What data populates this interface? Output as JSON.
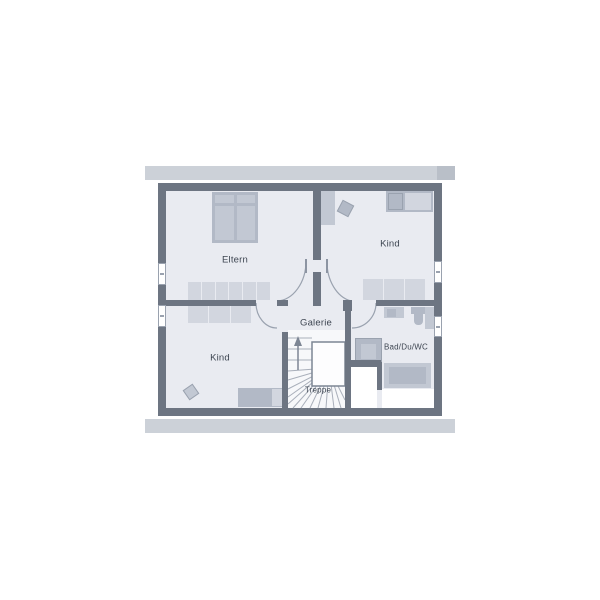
{
  "plan_title": "Obergeschoss Grundriss",
  "rooms": {
    "parents": "Eltern",
    "child_top": "Kind",
    "child_bottom": "Kind",
    "bath": "Bad/Du/WC",
    "gallery": "Galerie",
    "stairs": "Treppe"
  },
  "colors": {
    "wall": "#6d7582",
    "floor": "#e9ebf1",
    "band": "#ccd1d8",
    "band_cap": "#b9bfc8",
    "furn_light": "#d2d6df",
    "furn_mid": "#c2c8d3",
    "furn_dark": "#b2b9c6",
    "stair_bg": "#f7f8fa",
    "line": "#9aa2af",
    "tread": "#a9afba",
    "text": "#3e4652",
    "void_border": "#7d8694",
    "leaf": "#8c94a2"
  }
}
